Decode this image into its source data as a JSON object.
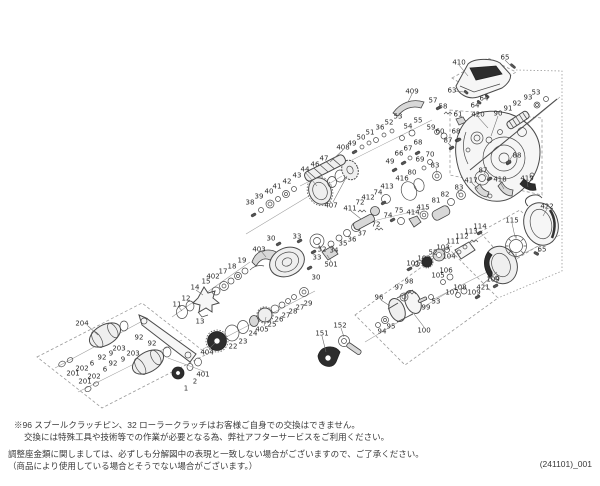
{
  "page": {
    "background": "#ffffff",
    "doc_number": "(241101)_001",
    "notes": {
      "line1": "※96 スプールクラッチピン、32 ローラークラッチはお客様ご自身での交換はできません。",
      "line2": "交換には特殊工具や技術等での作業が必要となる為、弊社アフターサービスをご利用ください。",
      "line3": "調整座金類に関しましては、必ずしも分解図中の表現と一致しない場合がございますので、ご了承ください。",
      "line4": "（商品により使用している場合とそうでない場合がございます。）"
    }
  },
  "diagram": {
    "type": "exploded-parts-diagram",
    "label_color": "#2b2b2b",
    "line_color": "#4a4a4a",
    "labels": [
      {
        "t": "410",
        "x": 459,
        "y": 62
      },
      {
        "t": "65",
        "x": 505,
        "y": 57
      },
      {
        "t": "63",
        "x": 452,
        "y": 90
      },
      {
        "t": "64",
        "x": 484,
        "y": 98
      },
      {
        "t": "64",
        "x": 475,
        "y": 105
      },
      {
        "t": "409",
        "x": 412,
        "y": 91
      },
      {
        "t": "57",
        "x": 433,
        "y": 100
      },
      {
        "t": "58",
        "x": 443,
        "y": 106
      },
      {
        "t": "61",
        "x": 458,
        "y": 114
      },
      {
        "t": "59",
        "x": 431,
        "y": 127
      },
      {
        "t": "60",
        "x": 440,
        "y": 131
      },
      {
        "t": "420",
        "x": 478,
        "y": 114
      },
      {
        "t": "90",
        "x": 498,
        "y": 113
      },
      {
        "t": "91",
        "x": 508,
        "y": 108
      },
      {
        "t": "92",
        "x": 517,
        "y": 103
      },
      {
        "t": "93",
        "x": 528,
        "y": 97
      },
      {
        "t": "53",
        "x": 536,
        "y": 92
      },
      {
        "t": "36",
        "x": 380,
        "y": 127
      },
      {
        "t": "52",
        "x": 389,
        "y": 122
      },
      {
        "t": "53",
        "x": 398,
        "y": 116
      },
      {
        "t": "54",
        "x": 408,
        "y": 126
      },
      {
        "t": "55",
        "x": 418,
        "y": 120
      },
      {
        "t": "51",
        "x": 370,
        "y": 132
      },
      {
        "t": "50",
        "x": 361,
        "y": 137
      },
      {
        "t": "49",
        "x": 352,
        "y": 143
      },
      {
        "t": "408",
        "x": 343,
        "y": 147
      },
      {
        "t": "66",
        "x": 399,
        "y": 153
      },
      {
        "t": "67",
        "x": 408,
        "y": 148
      },
      {
        "t": "68",
        "x": 418,
        "y": 142
      },
      {
        "t": "49",
        "x": 390,
        "y": 161
      },
      {
        "t": "69",
        "x": 420,
        "y": 159
      },
      {
        "t": "70",
        "x": 430,
        "y": 154
      },
      {
        "t": "68",
        "x": 456,
        "y": 131
      },
      {
        "t": "87",
        "x": 448,
        "y": 140
      },
      {
        "t": "88",
        "x": 517,
        "y": 155
      },
      {
        "t": "87",
        "x": 483,
        "y": 170
      },
      {
        "t": "417",
        "x": 471,
        "y": 180
      },
      {
        "t": "418",
        "x": 500,
        "y": 179
      },
      {
        "t": "419",
        "x": 527,
        "y": 178
      },
      {
        "t": "416",
        "x": 402,
        "y": 178
      },
      {
        "t": "80",
        "x": 412,
        "y": 172
      },
      {
        "t": "83",
        "x": 435,
        "y": 165
      },
      {
        "t": "81",
        "x": 436,
        "y": 200
      },
      {
        "t": "82",
        "x": 445,
        "y": 194
      },
      {
        "t": "83",
        "x": 459,
        "y": 187
      },
      {
        "t": "38",
        "x": 250,
        "y": 202
      },
      {
        "t": "39",
        "x": 259,
        "y": 196
      },
      {
        "t": "40",
        "x": 269,
        "y": 191
      },
      {
        "t": "41",
        "x": 277,
        "y": 186
      },
      {
        "t": "42",
        "x": 287,
        "y": 181
      },
      {
        "t": "43",
        "x": 297,
        "y": 175
      },
      {
        "t": "44",
        "x": 305,
        "y": 169
      },
      {
        "t": "46",
        "x": 315,
        "y": 164
      },
      {
        "t": "47",
        "x": 324,
        "y": 158
      },
      {
        "t": "407",
        "x": 331,
        "y": 205
      },
      {
        "t": "411",
        "x": 350,
        "y": 208
      },
      {
        "t": "72",
        "x": 360,
        "y": 202
      },
      {
        "t": "74",
        "x": 378,
        "y": 192
      },
      {
        "t": "412",
        "x": 368,
        "y": 197
      },
      {
        "t": "413",
        "x": 387,
        "y": 186
      },
      {
        "t": "74",
        "x": 388,
        "y": 215
      },
      {
        "t": "72",
        "x": 376,
        "y": 224
      },
      {
        "t": "75",
        "x": 399,
        "y": 210
      },
      {
        "t": "414",
        "x": 413,
        "y": 212
      },
      {
        "t": "415",
        "x": 423,
        "y": 207
      },
      {
        "t": "30",
        "x": 271,
        "y": 238
      },
      {
        "t": "33",
        "x": 297,
        "y": 236
      },
      {
        "t": "32",
        "x": 322,
        "y": 249
      },
      {
        "t": "33",
        "x": 317,
        "y": 257
      },
      {
        "t": "34",
        "x": 334,
        "y": 250
      },
      {
        "t": "35",
        "x": 343,
        "y": 243
      },
      {
        "t": "36",
        "x": 352,
        "y": 239
      },
      {
        "t": "37",
        "x": 362,
        "y": 233
      },
      {
        "t": "501",
        "x": 331,
        "y": 264
      },
      {
        "t": "30",
        "x": 316,
        "y": 277
      },
      {
        "t": "403",
        "x": 259,
        "y": 249
      },
      {
        "t": "11",
        "x": 177,
        "y": 304
      },
      {
        "t": "12",
        "x": 186,
        "y": 298
      },
      {
        "t": "13",
        "x": 200,
        "y": 321
      },
      {
        "t": "14",
        "x": 195,
        "y": 287
      },
      {
        "t": "15",
        "x": 206,
        "y": 281
      },
      {
        "t": "402",
        "x": 213,
        "y": 276
      },
      {
        "t": "17",
        "x": 223,
        "y": 271
      },
      {
        "t": "18",
        "x": 232,
        "y": 266
      },
      {
        "t": "19",
        "x": 242,
        "y": 260
      },
      {
        "t": "404",
        "x": 207,
        "y": 352
      },
      {
        "t": "22",
        "x": 233,
        "y": 346
      },
      {
        "t": "23",
        "x": 243,
        "y": 341
      },
      {
        "t": "24",
        "x": 253,
        "y": 333
      },
      {
        "t": "405",
        "x": 262,
        "y": 329
      },
      {
        "t": "25",
        "x": 272,
        "y": 324
      },
      {
        "t": "26",
        "x": 279,
        "y": 319
      },
      {
        "t": "27",
        "x": 286,
        "y": 315
      },
      {
        "t": "28",
        "x": 293,
        "y": 311
      },
      {
        "t": "27",
        "x": 300,
        "y": 307
      },
      {
        "t": "29",
        "x": 308,
        "y": 303
      },
      {
        "t": "204",
        "x": 82,
        "y": 323
      },
      {
        "t": "92",
        "x": 139,
        "y": 337
      },
      {
        "t": "92",
        "x": 152,
        "y": 343
      },
      {
        "t": "203",
        "x": 119,
        "y": 348
      },
      {
        "t": "9",
        "x": 111,
        "y": 353
      },
      {
        "t": "92",
        "x": 102,
        "y": 357
      },
      {
        "t": "6",
        "x": 92,
        "y": 363
      },
      {
        "t": "202",
        "x": 82,
        "y": 368
      },
      {
        "t": "201",
        "x": 73,
        "y": 373
      },
      {
        "t": "203",
        "x": 133,
        "y": 353
      },
      {
        "t": "9",
        "x": 123,
        "y": 359
      },
      {
        "t": "92",
        "x": 113,
        "y": 363
      },
      {
        "t": "6",
        "x": 105,
        "y": 369
      },
      {
        "t": "202",
        "x": 94,
        "y": 376
      },
      {
        "t": "201",
        "x": 85,
        "y": 381
      },
      {
        "t": "1",
        "x": 186,
        "y": 388
      },
      {
        "t": "2",
        "x": 195,
        "y": 381
      },
      {
        "t": "401",
        "x": 203,
        "y": 374
      },
      {
        "t": "96",
        "x": 379,
        "y": 297
      },
      {
        "t": "97",
        "x": 399,
        "y": 287
      },
      {
        "t": "98",
        "x": 409,
        "y": 281
      },
      {
        "t": "99",
        "x": 426,
        "y": 307
      },
      {
        "t": "53",
        "x": 436,
        "y": 301
      },
      {
        "t": "94",
        "x": 382,
        "y": 331
      },
      {
        "t": "95",
        "x": 391,
        "y": 326
      },
      {
        "t": "100",
        "x": 424,
        "y": 330
      },
      {
        "t": "151",
        "x": 322,
        "y": 333
      },
      {
        "t": "152",
        "x": 340,
        "y": 325
      },
      {
        "t": "101",
        "x": 413,
        "y": 263
      },
      {
        "t": "102",
        "x": 424,
        "y": 258
      },
      {
        "t": "52",
        "x": 433,
        "y": 252
      },
      {
        "t": "103",
        "x": 443,
        "y": 247
      },
      {
        "t": "104",
        "x": 449,
        "y": 256
      },
      {
        "t": "105",
        "x": 438,
        "y": 275
      },
      {
        "t": "106",
        "x": 446,
        "y": 270
      },
      {
        "t": "107",
        "x": 452,
        "y": 292
      },
      {
        "t": "108",
        "x": 460,
        "y": 287
      },
      {
        "t": "109",
        "x": 474,
        "y": 292
      },
      {
        "t": "421",
        "x": 483,
        "y": 287
      },
      {
        "t": "109",
        "x": 493,
        "y": 279
      },
      {
        "t": "111",
        "x": 453,
        "y": 241
      },
      {
        "t": "112",
        "x": 462,
        "y": 236
      },
      {
        "t": "113",
        "x": 471,
        "y": 231
      },
      {
        "t": "114",
        "x": 480,
        "y": 226
      },
      {
        "t": "115",
        "x": 512,
        "y": 220
      },
      {
        "t": "422",
        "x": 547,
        "y": 206
      },
      {
        "t": "65",
        "x": 542,
        "y": 249
      }
    ],
    "leaders": [
      [
        459,
        65,
        468,
        76
      ],
      [
        505,
        60,
        512,
        67
      ],
      [
        455,
        91,
        464,
        92
      ],
      [
        478,
        117,
        488,
        128
      ],
      [
        498,
        116,
        491,
        136
      ],
      [
        412,
        94,
        408,
        102
      ],
      [
        343,
        150,
        330,
        162
      ],
      [
        333,
        202,
        347,
        176
      ],
      [
        88,
        326,
        98,
        335
      ],
      [
        424,
        327,
        414,
        314
      ],
      [
        209,
        349,
        215,
        343
      ],
      [
        261,
        251,
        266,
        257
      ],
      [
        264,
        326,
        266,
        317
      ],
      [
        331,
        261,
        327,
        255
      ],
      [
        483,
        284,
        497,
        272
      ],
      [
        512,
        223,
        515,
        237
      ],
      [
        547,
        209,
        543,
        216
      ],
      [
        540,
        250,
        537,
        253
      ],
      [
        305,
        172,
        317,
        186
      ],
      [
        196,
        290,
        203,
        295
      ],
      [
        322,
        251,
        318,
        243
      ],
      [
        381,
        300,
        390,
        306
      ],
      [
        322,
        336,
        326,
        352
      ],
      [
        341,
        328,
        344,
        337
      ],
      [
        178,
        306,
        182,
        311
      ],
      [
        515,
        152,
        509,
        161
      ],
      [
        484,
        173,
        489,
        179
      ],
      [
        472,
        183,
        478,
        189
      ],
      [
        500,
        182,
        504,
        189
      ],
      [
        527,
        181,
        528,
        187
      ],
      [
        351,
        211,
        361,
        219
      ],
      [
        458,
        190,
        459,
        194
      ],
      [
        436,
        168,
        437,
        173
      ],
      [
        448,
        143,
        452,
        147
      ]
    ]
  }
}
